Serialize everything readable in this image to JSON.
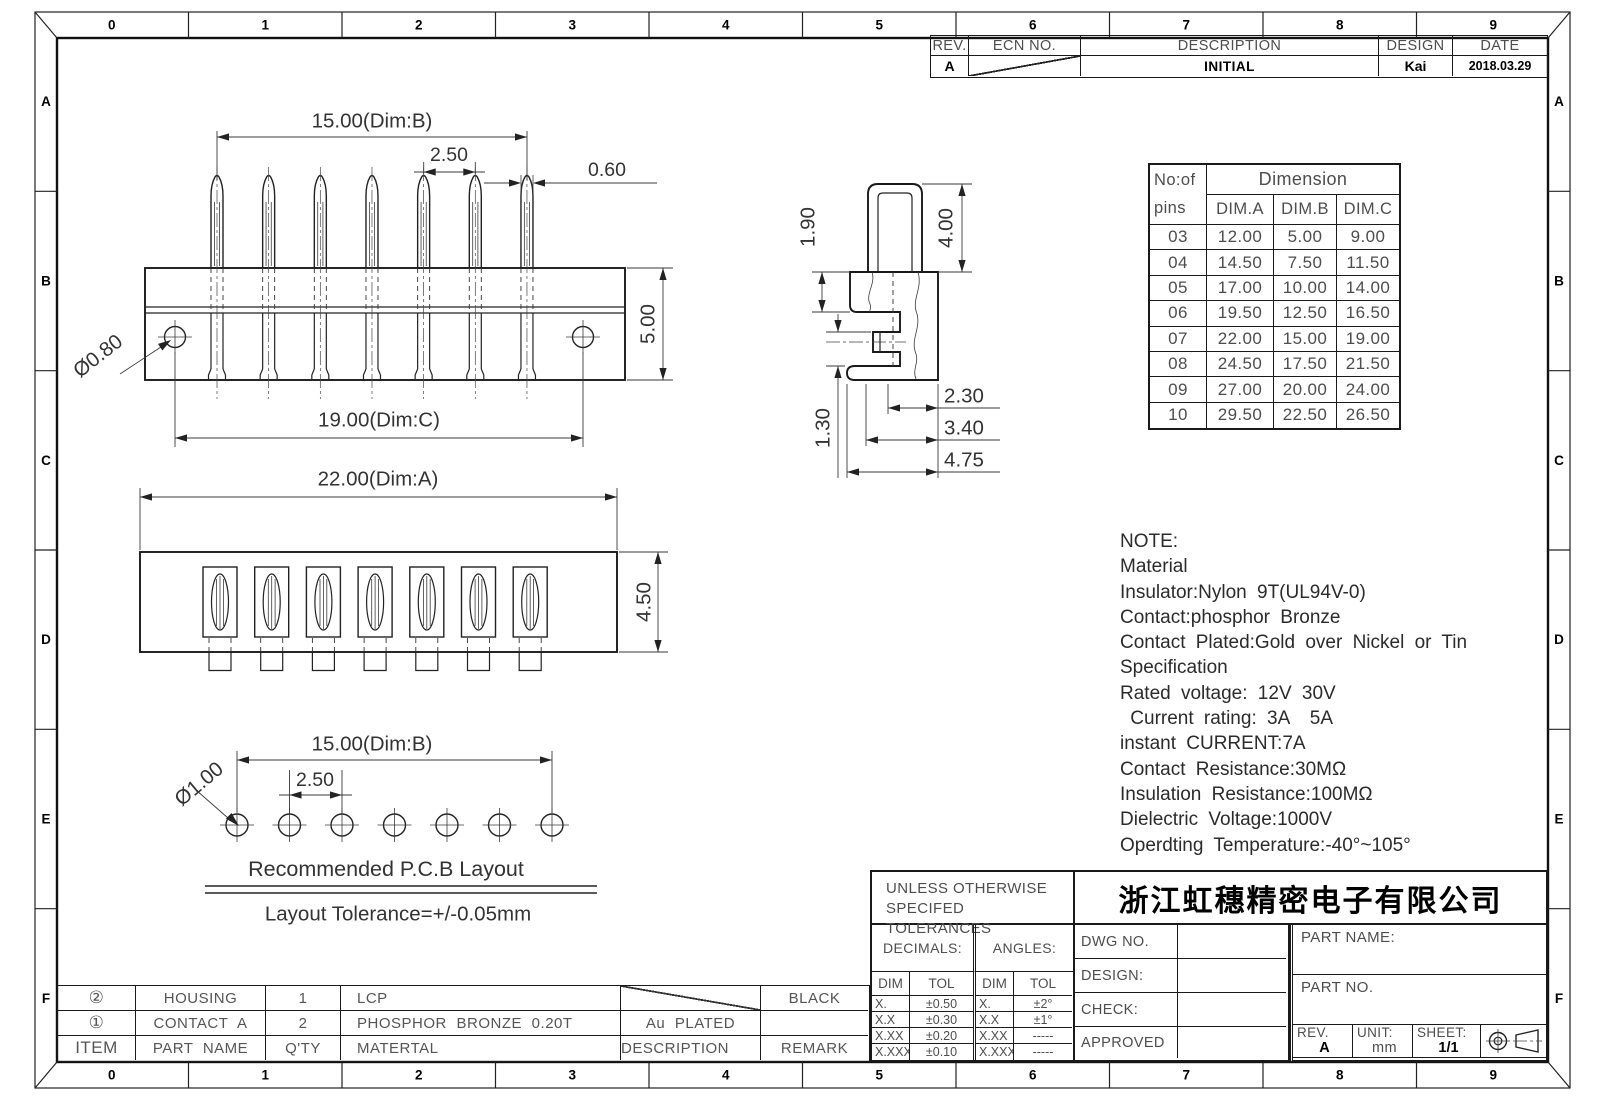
{
  "frame": {
    "columns": [
      "0",
      "1",
      "2",
      "3",
      "4",
      "5",
      "6",
      "7",
      "8",
      "9"
    ],
    "rows": [
      "A",
      "B",
      "C",
      "D",
      "E",
      "F"
    ]
  },
  "revision_table": {
    "headers": [
      "REV.",
      "ECN NO.",
      "DESCRIPTION",
      "DESIGN",
      "DATE"
    ],
    "entry": {
      "rev": "A",
      "description": "INITIAL",
      "design": "Kai",
      "date": "2018.03.29"
    }
  },
  "dimension_table": {
    "pins_header": [
      "No:of",
      "pins"
    ],
    "group_header": "Dimension",
    "columns": [
      "DIM.A",
      "DIM.B",
      "DIM.C"
    ],
    "rows": [
      [
        "03",
        "12.00",
        "5.00",
        "9.00"
      ],
      [
        "04",
        "14.50",
        "7.50",
        "11.50"
      ],
      [
        "05",
        "17.00",
        "10.00",
        "14.00"
      ],
      [
        "06",
        "19.50",
        "12.50",
        "16.50"
      ],
      [
        "07",
        "22.00",
        "15.00",
        "19.00"
      ],
      [
        "08",
        "24.50",
        "17.50",
        "21.50"
      ],
      [
        "09",
        "27.00",
        "20.00",
        "24.00"
      ],
      [
        "10",
        "29.50",
        "22.50",
        "26.50"
      ]
    ]
  },
  "views": {
    "pin_count": 7,
    "top_view": {
      "dim_b": "15.00(Dim:B)",
      "pitch": "2.50",
      "pin_width": "0.60",
      "height": "5.00",
      "hole": "Ø0.80",
      "dim_c": "19.00(Dim:C)"
    },
    "bottom_view": {
      "dim_a": "22.00(Dim:A)",
      "height": "4.50"
    },
    "side_view": {
      "d1": "1.90",
      "d2": "4.00",
      "d3": "1.30",
      "d4": "2.30",
      "d5": "3.40",
      "d6": "4.75"
    },
    "pcb_layout": {
      "hole": "Ø1.00",
      "dim_b": "15.00(Dim:B)",
      "pitch": "2.50",
      "title": "Recommended P.C.B Layout",
      "tolerance": "Layout Tolerance=+/-0.05mm"
    }
  },
  "notes": {
    "lines": [
      "NOTE:",
      "Material",
      "Insulator:Nylon 9T(UL94V-0)",
      "Contact:phosphor Bronze",
      "Contact Plated:Gold over Nickel or Tin",
      "Specification",
      "Rated voltage: 12V 30V",
      " Current rating: 3A  5A",
      "instant CURRENT:7A",
      "Contact Resistance:30MΩ",
      "Insulation Resistance:100MΩ",
      "Dielectric Voltage:1000V",
      "Operdting Temperature:-40°~105°"
    ]
  },
  "tolerance_block": {
    "title_line1": "UNLESS OTHERWISE",
    "title_line2": "SPECIFED TOLERANCES",
    "decimals_label": "DECIMALS:",
    "angles_label": "ANGLES:",
    "dim_header": "DIM",
    "tol_header": "TOL",
    "decimals_rows": [
      [
        "X.",
        "±0.50"
      ],
      [
        "X.X",
        "±0.30"
      ],
      [
        "X.XX",
        "±0.20"
      ],
      [
        "X.XXX",
        "±0.10"
      ]
    ],
    "angles_rows": [
      [
        "X.",
        "±2°"
      ],
      [
        "X.X",
        "±1°"
      ],
      [
        "X.XX",
        "-----"
      ],
      [
        "X.XXX",
        "-----"
      ]
    ]
  },
  "title_block": {
    "company": "浙江虹穗精密电子有限公司",
    "dwg_no_label": "DWG NO.",
    "design_label": "DESIGN:",
    "check_label": "CHECK:",
    "approved_label": "APPROVED",
    "part_name_label": "PART NAME:",
    "part_no_label": "PART NO.",
    "rev_label": "REV.",
    "rev_value": "A",
    "unit_label": "UNIT:",
    "unit_value": "mm",
    "sheet_label": "SHEET:",
    "sheet_value": "1/1"
  },
  "bom": {
    "headers": [
      "ITEM",
      "PART NAME",
      "Q'TY",
      "MATERTAL",
      "DESCRIPTION",
      "REMARK"
    ],
    "rows": [
      [
        "②",
        "HOUSING",
        "1",
        "LCP",
        "",
        "BLACK"
      ],
      [
        "①",
        "CONTACT A",
        "2",
        "PHOSPHOR BRONZE 0.20T",
        "Au PLATED",
        ""
      ]
    ]
  }
}
